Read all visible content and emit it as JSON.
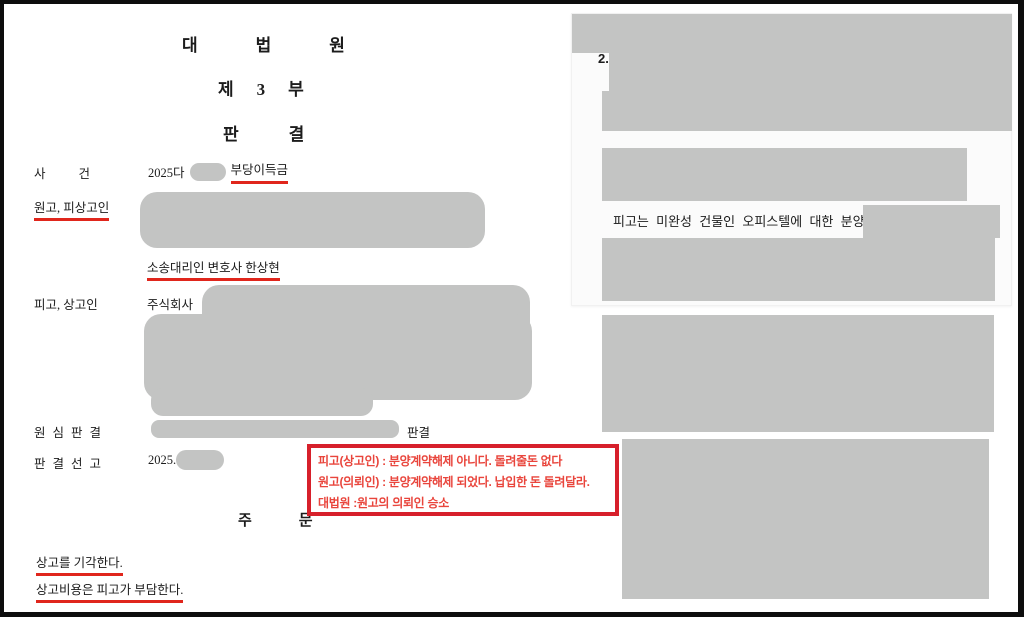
{
  "document": {
    "court_title": "대법원",
    "division_title": "제3부",
    "judgment_title": "판결",
    "case": {
      "label": "사건",
      "number_prefix": "2025다",
      "type": "부당이득금"
    },
    "plaintiff": {
      "label": "원고, 피상고인",
      "counsel": "소송대리인 변호사 한상현"
    },
    "defendant": {
      "label": "피고, 상고인",
      "prefix": "주식회사"
    },
    "lower_court": {
      "label": "원심판결",
      "suffix": "판결"
    },
    "sentencing": {
      "label": "판결선고",
      "value": "2025."
    },
    "order": {
      "heading": "주문",
      "line1": "상고를 기각한다.",
      "line2": "상고비용은 피고가 부담한다."
    }
  },
  "annotation_box": {
    "line1": "피고(상고인) : 분양계약해제 아니다. 돌려줄돈 없다",
    "line2": "원고(의뢰인) : 분양계약해제 되었다. 납입한 돈 돌려달라.",
    "line3": "대법원 :원고의 의뢰인 승소"
  },
  "right_page": {
    "section_number": "2.",
    "visible_text": "피고는 미완성 건물인 오피스텔에 대한 분양권은"
  },
  "colors": {
    "redaction_gray": "#c3c4c3",
    "underline_red": "#e0261c",
    "annotation_border_red": "#d7202b",
    "annotation_text_red": "#e9453c"
  }
}
